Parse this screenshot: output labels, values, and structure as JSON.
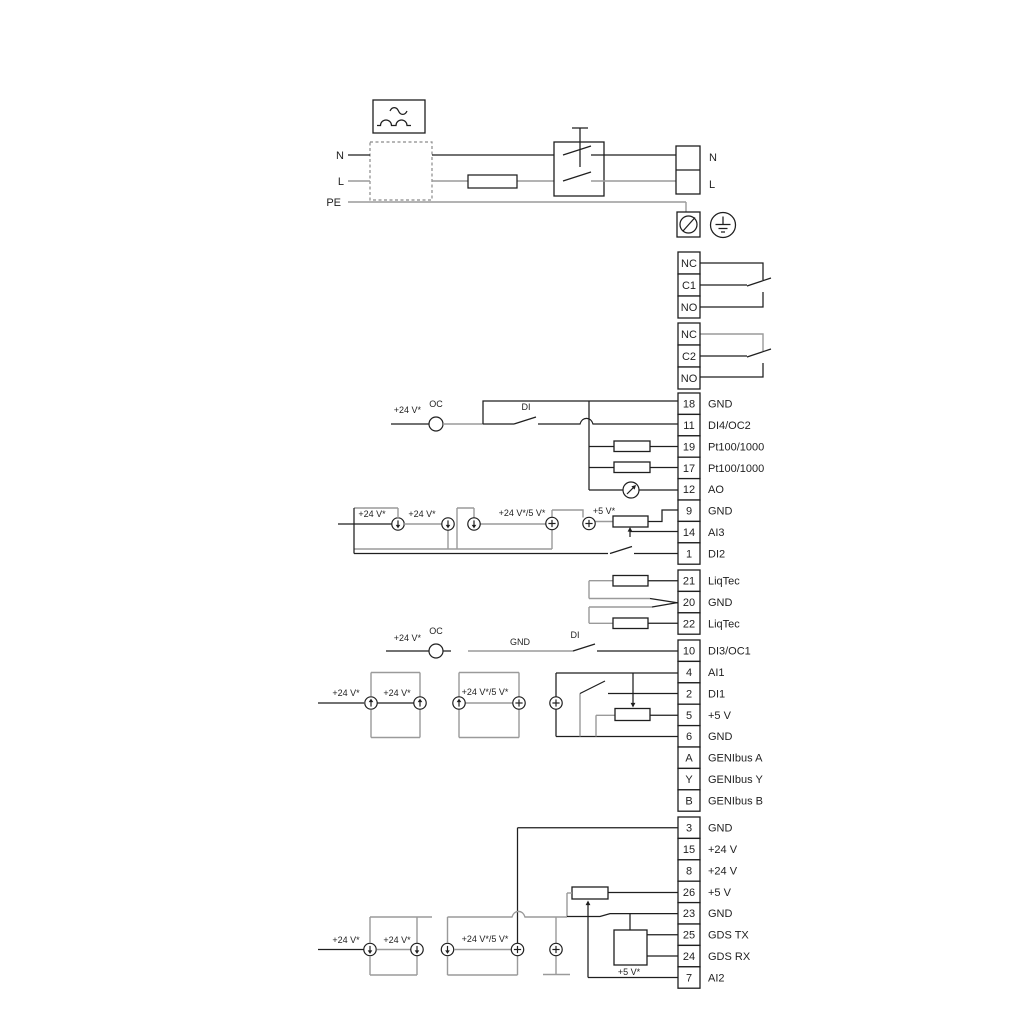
{
  "colors": {
    "wire_black": "#1f1f1f",
    "wire_gray": "#9a9a9a",
    "text": "#1f1f1f",
    "background": "#ffffff"
  },
  "power_section": {
    "left_labels": [
      "N",
      "L",
      "PE"
    ],
    "right_labels": [
      "N",
      "L"
    ]
  },
  "terminal_groups": {
    "relay1": {
      "rows": [
        {
          "n": "NC"
        },
        {
          "n": "C1"
        },
        {
          "n": "NO"
        }
      ]
    },
    "relay2": {
      "rows": [
        {
          "n": "NC"
        },
        {
          "n": "C2"
        },
        {
          "n": "NO"
        }
      ]
    },
    "t1": {
      "rows": [
        {
          "n": "18",
          "l": "GND"
        },
        {
          "n": "11",
          "l": "DI4/OC2"
        },
        {
          "n": "19",
          "l": "Pt100/1000"
        },
        {
          "n": "17",
          "l": "Pt100/1000"
        },
        {
          "n": "12",
          "l": "AO"
        },
        {
          "n": "9",
          "l": "GND"
        },
        {
          "n": "14",
          "l": "AI3"
        },
        {
          "n": "1",
          "l": "DI2"
        }
      ]
    },
    "t2": {
      "rows": [
        {
          "n": "21",
          "l": "LiqTec"
        },
        {
          "n": "20",
          "l": "GND"
        },
        {
          "n": "22",
          "l": "LiqTec"
        }
      ]
    },
    "t3": {
      "rows": [
        {
          "n": "10",
          "l": "DI3/OC1"
        },
        {
          "n": "4",
          "l": "AI1"
        },
        {
          "n": "2",
          "l": "DI1"
        },
        {
          "n": "5",
          "l": "+5 V"
        },
        {
          "n": "6",
          "l": "GND"
        },
        {
          "n": "A",
          "l": "GENIbus A"
        },
        {
          "n": "Y",
          "l": "GENIbus Y"
        },
        {
          "n": "B",
          "l": "GENIbus B"
        }
      ]
    },
    "t4": {
      "rows": [
        {
          "n": "3",
          "l": "GND"
        },
        {
          "n": "15",
          "l": "+24 V"
        },
        {
          "n": "8",
          "l": "+24 V"
        },
        {
          "n": "26",
          "l": "+5 V"
        },
        {
          "n": "23",
          "l": "GND"
        },
        {
          "n": "25",
          "l": "GDS TX"
        },
        {
          "n": "24",
          "l": "GDS RX"
        },
        {
          "n": "7",
          "l": "AI2"
        }
      ]
    }
  },
  "float_labels": [
    {
      "text": "N",
      "x": 344,
      "y": 159,
      "a": "end",
      "s": 11
    },
    {
      "text": "L",
      "x": 344,
      "y": 185,
      "a": "end",
      "s": 11
    },
    {
      "text": "PE",
      "x": 341,
      "y": 206,
      "a": "end",
      "s": 11
    },
    {
      "text": "N",
      "x": 709,
      "y": 161,
      "a": "start",
      "s": 11
    },
    {
      "text": "L",
      "x": 709,
      "y": 188,
      "a": "start",
      "s": 11
    },
    {
      "text": "+24 V*",
      "x": 421,
      "y": 413,
      "a": "end",
      "s": 9
    },
    {
      "text": "OC",
      "x": 436,
      "y": 407,
      "a": "middle",
      "s": 9
    },
    {
      "text": "DI",
      "x": 526,
      "y": 410,
      "a": "middle",
      "s": 9
    },
    {
      "text": "+24 V*",
      "x": 372,
      "y": 517,
      "a": "middle",
      "s": 9
    },
    {
      "text": "+24 V*",
      "x": 422,
      "y": 517,
      "a": "middle",
      "s": 9
    },
    {
      "text": "+24 V*/5 V*",
      "x": 522,
      "y": 516,
      "a": "middle",
      "s": 9
    },
    {
      "text": "+5 V*",
      "x": 604,
      "y": 514,
      "a": "middle",
      "s": 9
    },
    {
      "text": "+24 V*",
      "x": 421,
      "y": 641,
      "a": "end",
      "s": 9
    },
    {
      "text": "OC",
      "x": 436,
      "y": 634,
      "a": "middle",
      "s": 9
    },
    {
      "text": "GND",
      "x": 520,
      "y": 645,
      "a": "middle",
      "s": 9
    },
    {
      "text": "DI",
      "x": 575,
      "y": 638,
      "a": "middle",
      "s": 9
    },
    {
      "text": "+24 V*",
      "x": 346,
      "y": 696,
      "a": "middle",
      "s": 9
    },
    {
      "text": "+24 V*",
      "x": 397,
      "y": 696,
      "a": "middle",
      "s": 9
    },
    {
      "text": "+24 V*/5 V*",
      "x": 485,
      "y": 695,
      "a": "middle",
      "s": 9
    },
    {
      "text": "+24 V*",
      "x": 346,
      "y": 943,
      "a": "middle",
      "s": 9
    },
    {
      "text": "+24 V*",
      "x": 397,
      "y": 943,
      "a": "middle",
      "s": 9
    },
    {
      "text": "+24 V*/5 V*",
      "x": 485,
      "y": 942,
      "a": "middle",
      "s": 9
    },
    {
      "text": "+5 V*",
      "x": 629,
      "y": 975,
      "a": "middle",
      "s": 9
    }
  ]
}
